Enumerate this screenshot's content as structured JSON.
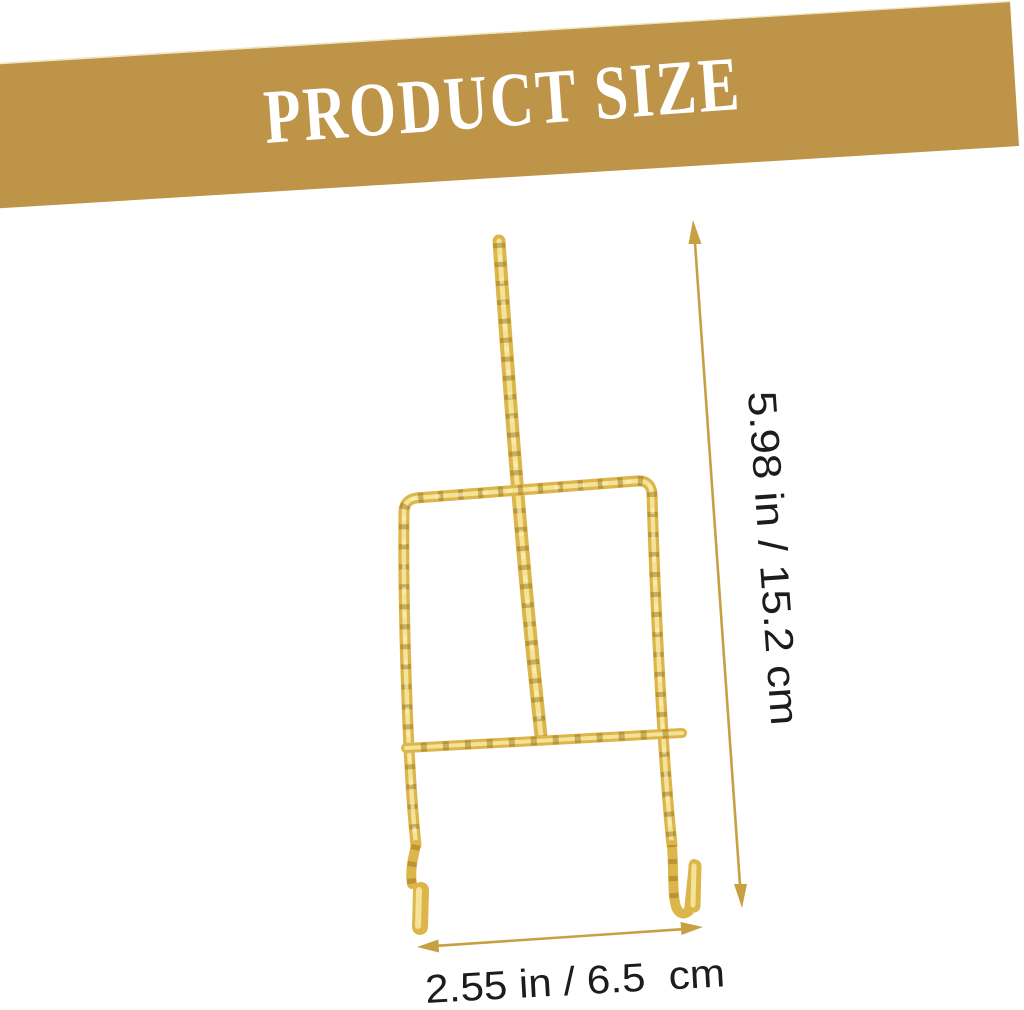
{
  "banner": {
    "title": "PRODUCT SIZE",
    "background_color": "#BE9449",
    "text_color": "#FFFFFF"
  },
  "product": {
    "description": "gold-twisted-wire-easel-display-stand",
    "wire_color": "#DCB64A",
    "wire_highlight_color": "#F6E79E",
    "wire_shadow_color": "#8A6718"
  },
  "dimensions": {
    "height_label": "5.98 in / 15.2 cm",
    "width_label": "2.55 in / 6.5  cm",
    "arrow_color": "#C6A042",
    "label_color": "#1C1C1C"
  }
}
